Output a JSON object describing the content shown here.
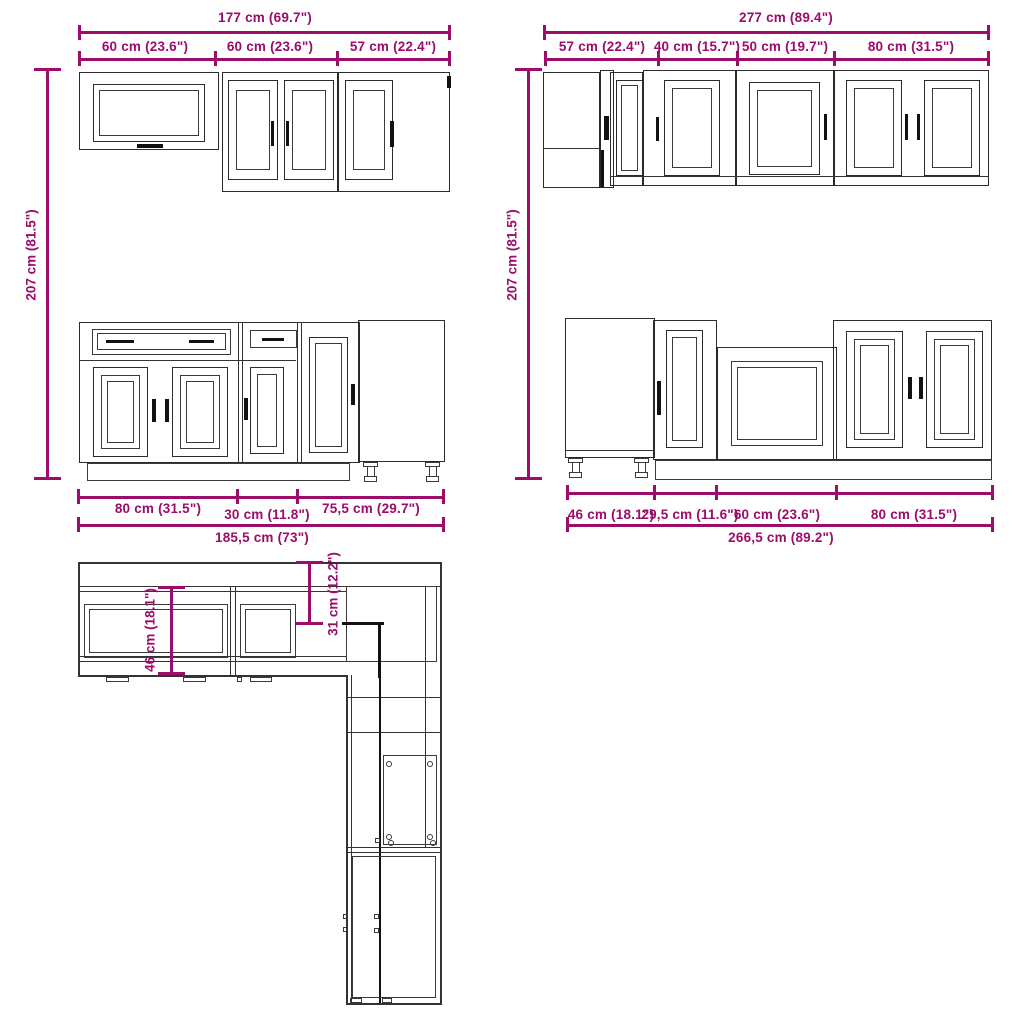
{
  "colors": {
    "dimension_accent": "#9B0C6B",
    "drawing_line": "#2b2b2b"
  },
  "views": {
    "wall_cabinets_left": {
      "total_width": "177 cm (69.7\")",
      "segment_widths": [
        "60 cm (23.6\")",
        "60 cm (23.6\")",
        "57 cm (22.4\")"
      ],
      "height": "207 cm (81.5\")"
    },
    "wall_cabinets_right": {
      "total_width": "277 cm (89.4\")",
      "segment_widths": [
        "57 cm (22.4\")",
        "40 cm (15.7\")",
        "50 cm (19.7\")",
        "80 cm (31.5\")"
      ],
      "height": "207 cm (81.5\")"
    },
    "base_cabinets_left": {
      "segment_widths": [
        "80 cm (31.5\")",
        "30 cm (11.8\")",
        "75,5 cm (29.7\")"
      ],
      "total_width": "185,5 cm (73\")"
    },
    "base_cabinets_right": {
      "segment_widths": [
        "46 cm (18.1\")",
        "29,5 cm (11.6\")",
        "60 cm (23.6\")",
        "80 cm (31.5\")"
      ],
      "total_width": "266,5 cm (89.2\")"
    },
    "plan_view": {
      "base_depth": "46 cm (18.1\")",
      "wall_depth": "31 cm (12.2\")"
    }
  }
}
